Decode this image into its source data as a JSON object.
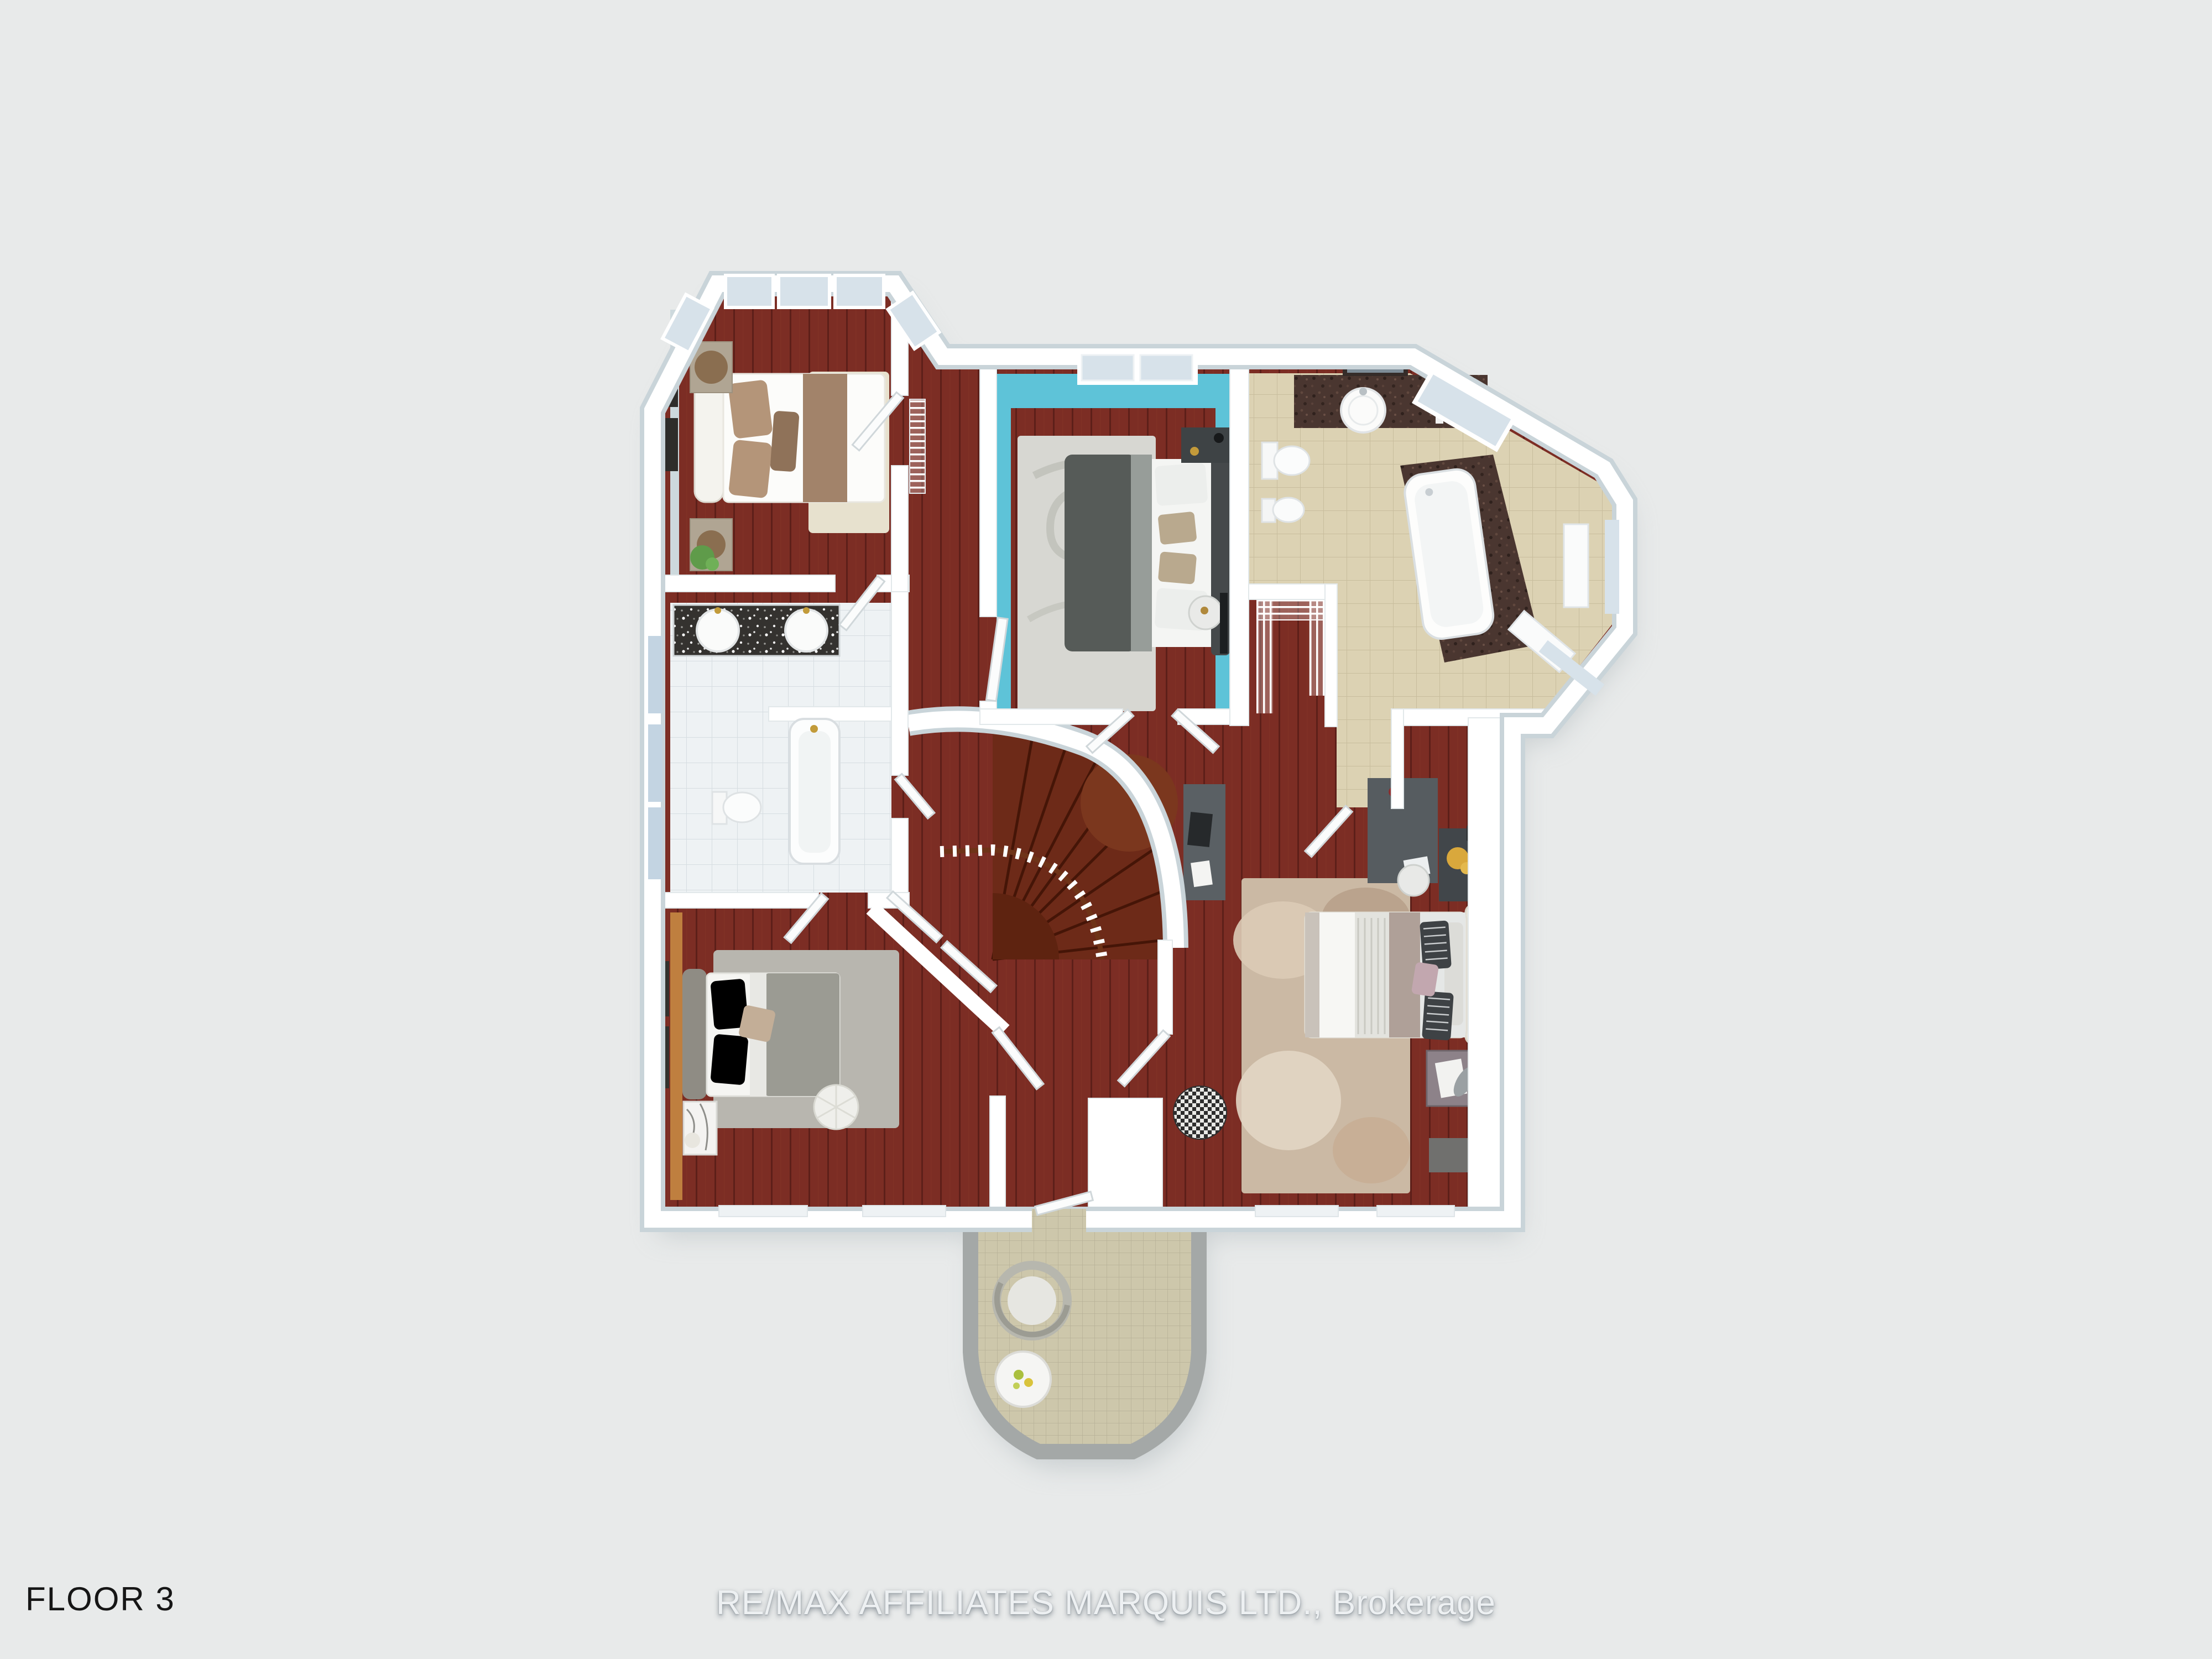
{
  "page": {
    "background": "#e8eaea"
  },
  "footer": {
    "floor_label": "FLOOR 3",
    "watermark": "RE/MAX AFFILIATES MARQUIS LTD., Brokerage",
    "floor_label_color": "#161616",
    "watermark_color": "#edf0f2"
  },
  "floorplan": {
    "view": "3D top-down rendered floor plan of the third floor of a house",
    "colors": {
      "wood_floor": "#7c2d24",
      "wood_plank_line": "#5d1f19",
      "stair_tread": "#6d2a18",
      "stair_tread_line": "#451507",
      "stair_landing": "#7b371e",
      "wall_white": "#ffffff",
      "wall_depth_gray": "#c9d4d9",
      "teal_wall": "#5ec3d8",
      "bath_wall_blue": "#a9bed2",
      "orange_accent_wall": "#bf7f3f",
      "ensuite_tile": "#dcd2b3",
      "ensuite_granite": "#4a3630",
      "white_tile": "#eef2f4",
      "vanity_granite": "#34322f",
      "balcony_tile": "#cdc7ab",
      "balcony_stone": "#a4a8a7",
      "rug_cream": "#e7e1ce",
      "rug_gray_swirl": "#d7d7d2",
      "rug_gray": "#b8b6af",
      "rug_beige": "#cbb9a4",
      "glass": "#d7e2ea",
      "shadow": "#a9b2b6"
    },
    "rooms": [
      {
        "id": "bedroom-top-left",
        "type": "bedroom",
        "features": [
          "octagonal bay window",
          "double bed with brown runner and pillows",
          "two tan nightstands with round tables",
          "potted plant",
          "cream area rug",
          "wall art frames"
        ]
      },
      {
        "id": "bedroom-blue",
        "type": "bedroom",
        "features": [
          "teal painted walls",
          "recessed window nook",
          "dark gray double bed",
          "gray swirl rug",
          "dark desk with lamp",
          "round side table",
          "wall mounted tv"
        ]
      },
      {
        "id": "ensuite-bathroom",
        "type": "bathroom",
        "features": [
          "dark granite vanity with round sink",
          "mirror",
          "flowers",
          "toilet",
          "bidet",
          "soaker tub on granite platform",
          "octagonal window bay",
          "beige tile floor"
        ]
      },
      {
        "id": "bathroom-main",
        "type": "bathroom",
        "features": [
          "speckled granite double vanity",
          "two round sinks with gold faucets",
          "toilet",
          "bathtub with gold fixtures",
          "white tile floor",
          "light blue walls"
        ]
      },
      {
        "id": "bedroom-bottom-left",
        "type": "bedroom",
        "features": [
          "orange accent wall",
          "gray double bed",
          "gray rug",
          "round tufted pouf",
          "marble nightstand with flowers",
          "angled closet doors",
          "wall art frames"
        ]
      },
      {
        "id": "bedroom-master",
        "type": "bedroom",
        "features": [
          "cream upholstered bed with striped pillows",
          "distressed beige rug",
          "gray desk with laptop",
          "console with lamp",
          "dresser with yellow flowers",
          "hexagonal mirror",
          "round side table",
          "houndstooth pouf",
          "two nightstands",
          "wall art"
        ]
      },
      {
        "id": "walk-in-closet",
        "type": "closet",
        "features": [
          "white wire shelving on three sides",
          "hardwood floor"
        ]
      },
      {
        "id": "staircase",
        "type": "curved staircase",
        "features": [
          "dark wood fan treads",
          "curved white wall",
          "wood handrail with white balusters",
          "curved upper landing"
        ]
      },
      {
        "id": "hallway",
        "type": "hallway",
        "features": [
          "red hardwood floor",
          "open white doors",
          "floor vent"
        ]
      },
      {
        "id": "balcony",
        "type": "balcony",
        "features": [
          "rounded stone parapet",
          "mosaic tile floor",
          "round wicker chair with cushion",
          "round white table with flowers"
        ]
      }
    ]
  }
}
